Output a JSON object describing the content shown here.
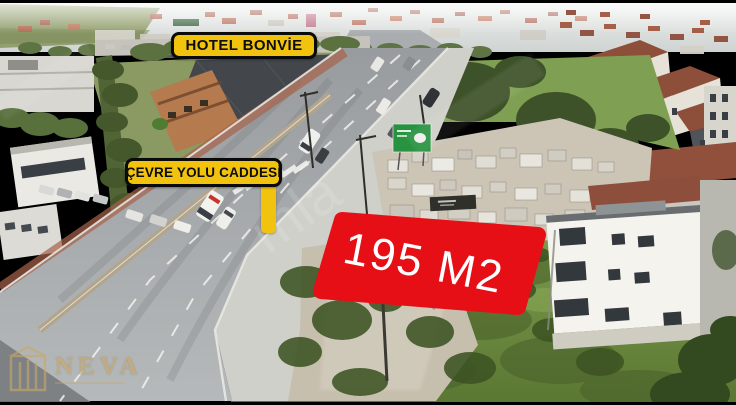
{
  "frame": {
    "letterbox_color": "#000000"
  },
  "overlays": {
    "hotel_label": "HOTEL BONVİE",
    "street_label": "ÇEVRE YOLU CADDESİ",
    "area_label": "195 M2",
    "label_bg_color": "#F2C30E",
    "label_border_color": "#0A0A0A",
    "label_text_color": "#0D0D0D",
    "area_plate_color": "#E60F16",
    "area_text_color": "#FFFFFF"
  },
  "agency_logo": {
    "name": "NEVA",
    "color": "#C9A96A"
  },
  "watermark": {
    "visible_fragment": "mla",
    "color": "#FFFFFF"
  }
}
